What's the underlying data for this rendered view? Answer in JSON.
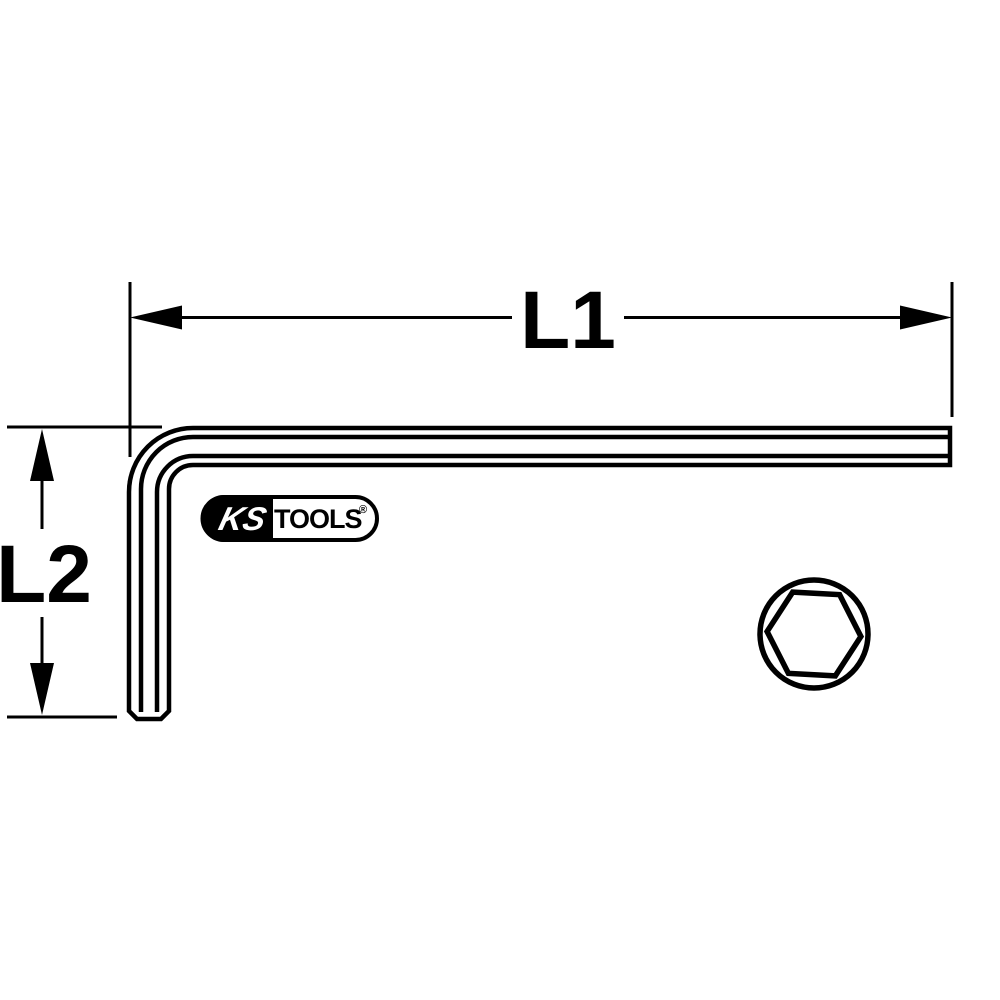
{
  "drawing": {
    "background": "#ffffff",
    "line_color": "#000000",
    "dimension_l1": {
      "label": "L1"
    },
    "dimension_l2": {
      "label": "L2"
    },
    "logo": {
      "left": "KS",
      "right": "TOOLS",
      "registered": "®"
    },
    "cross_section_icon": "hexagon-in-circle"
  }
}
